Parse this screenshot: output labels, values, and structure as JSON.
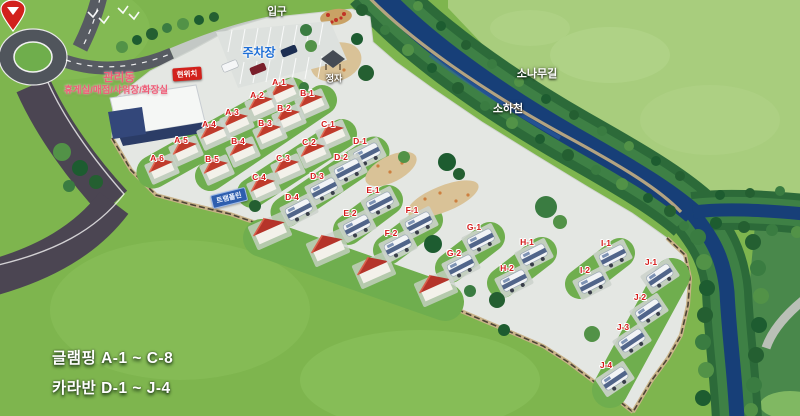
{
  "map": {
    "labels": {
      "entrance": "입구",
      "parking": "주차장",
      "pavilion": "정자",
      "current_location": "현위치",
      "building_title": "관리동",
      "building_subtitle": "휴게실/매점/샤워장/화장실",
      "play_sign": "트램폴린",
      "pine_road": "소나무길",
      "stream": "소하천"
    },
    "legend": {
      "glamping_range": "글램핑 A-1 ~ C-8",
      "caravan_range": "카라반 D-1 ~ J-4"
    },
    "sites": {
      "glamping": [
        {
          "id": "A-1",
          "x": 279,
          "y": 82
        },
        {
          "id": "A-2",
          "x": 257,
          "y": 95
        },
        {
          "id": "A-3",
          "x": 232,
          "y": 112
        },
        {
          "id": "A-4",
          "x": 209,
          "y": 124
        },
        {
          "id": "A-5",
          "x": 181,
          "y": 140
        },
        {
          "id": "A-6",
          "x": 157,
          "y": 158
        },
        {
          "id": "B-1",
          "x": 307,
          "y": 93
        },
        {
          "id": "B-2",
          "x": 284,
          "y": 108
        },
        {
          "id": "B-3",
          "x": 265,
          "y": 123
        },
        {
          "id": "B-4",
          "x": 238,
          "y": 141
        },
        {
          "id": "B-5",
          "x": 212,
          "y": 159
        },
        {
          "id": "C-1",
          "x": 328,
          "y": 124
        },
        {
          "id": "C-2",
          "x": 309,
          "y": 142
        },
        {
          "id": "C-3",
          "x": 283,
          "y": 158
        },
        {
          "id": "C-4",
          "x": 259,
          "y": 177
        }
      ],
      "caravan": [
        {
          "id": "D-1",
          "x": 360,
          "y": 141
        },
        {
          "id": "D-2",
          "x": 341,
          "y": 157
        },
        {
          "id": "D-3",
          "x": 317,
          "y": 176
        },
        {
          "id": "D-4",
          "x": 292,
          "y": 197
        },
        {
          "id": "E-1",
          "x": 373,
          "y": 190
        },
        {
          "id": "E-2",
          "x": 350,
          "y": 213
        },
        {
          "id": "F-1",
          "x": 412,
          "y": 210
        },
        {
          "id": "F-2",
          "x": 391,
          "y": 233
        },
        {
          "id": "G-1",
          "x": 474,
          "y": 227
        },
        {
          "id": "G-2",
          "x": 454,
          "y": 253
        },
        {
          "id": "H-1",
          "x": 527,
          "y": 242
        },
        {
          "id": "H-2",
          "x": 507,
          "y": 268
        },
        {
          "id": "I-1",
          "x": 606,
          "y": 243
        },
        {
          "id": "I-2",
          "x": 585,
          "y": 270
        },
        {
          "id": "J-1",
          "x": 651,
          "y": 262
        },
        {
          "id": "J-2",
          "x": 640,
          "y": 297
        },
        {
          "id": "J-3",
          "x": 623,
          "y": 327
        },
        {
          "id": "J-4",
          "x": 606,
          "y": 365
        }
      ]
    },
    "colors": {
      "grass": "#7eb54e",
      "hill": "#a8cd7d",
      "water": "#173f78",
      "camp_floor": "#e4e7e3",
      "tent_red": "#c03b2c",
      "site_label_red": "#d41b1b",
      "parking_text_blue": "#1f6fd6",
      "building_text_pink": "#ef5d77",
      "marker_red": "#d2211c",
      "sign_blue": "#2e5eae"
    }
  }
}
